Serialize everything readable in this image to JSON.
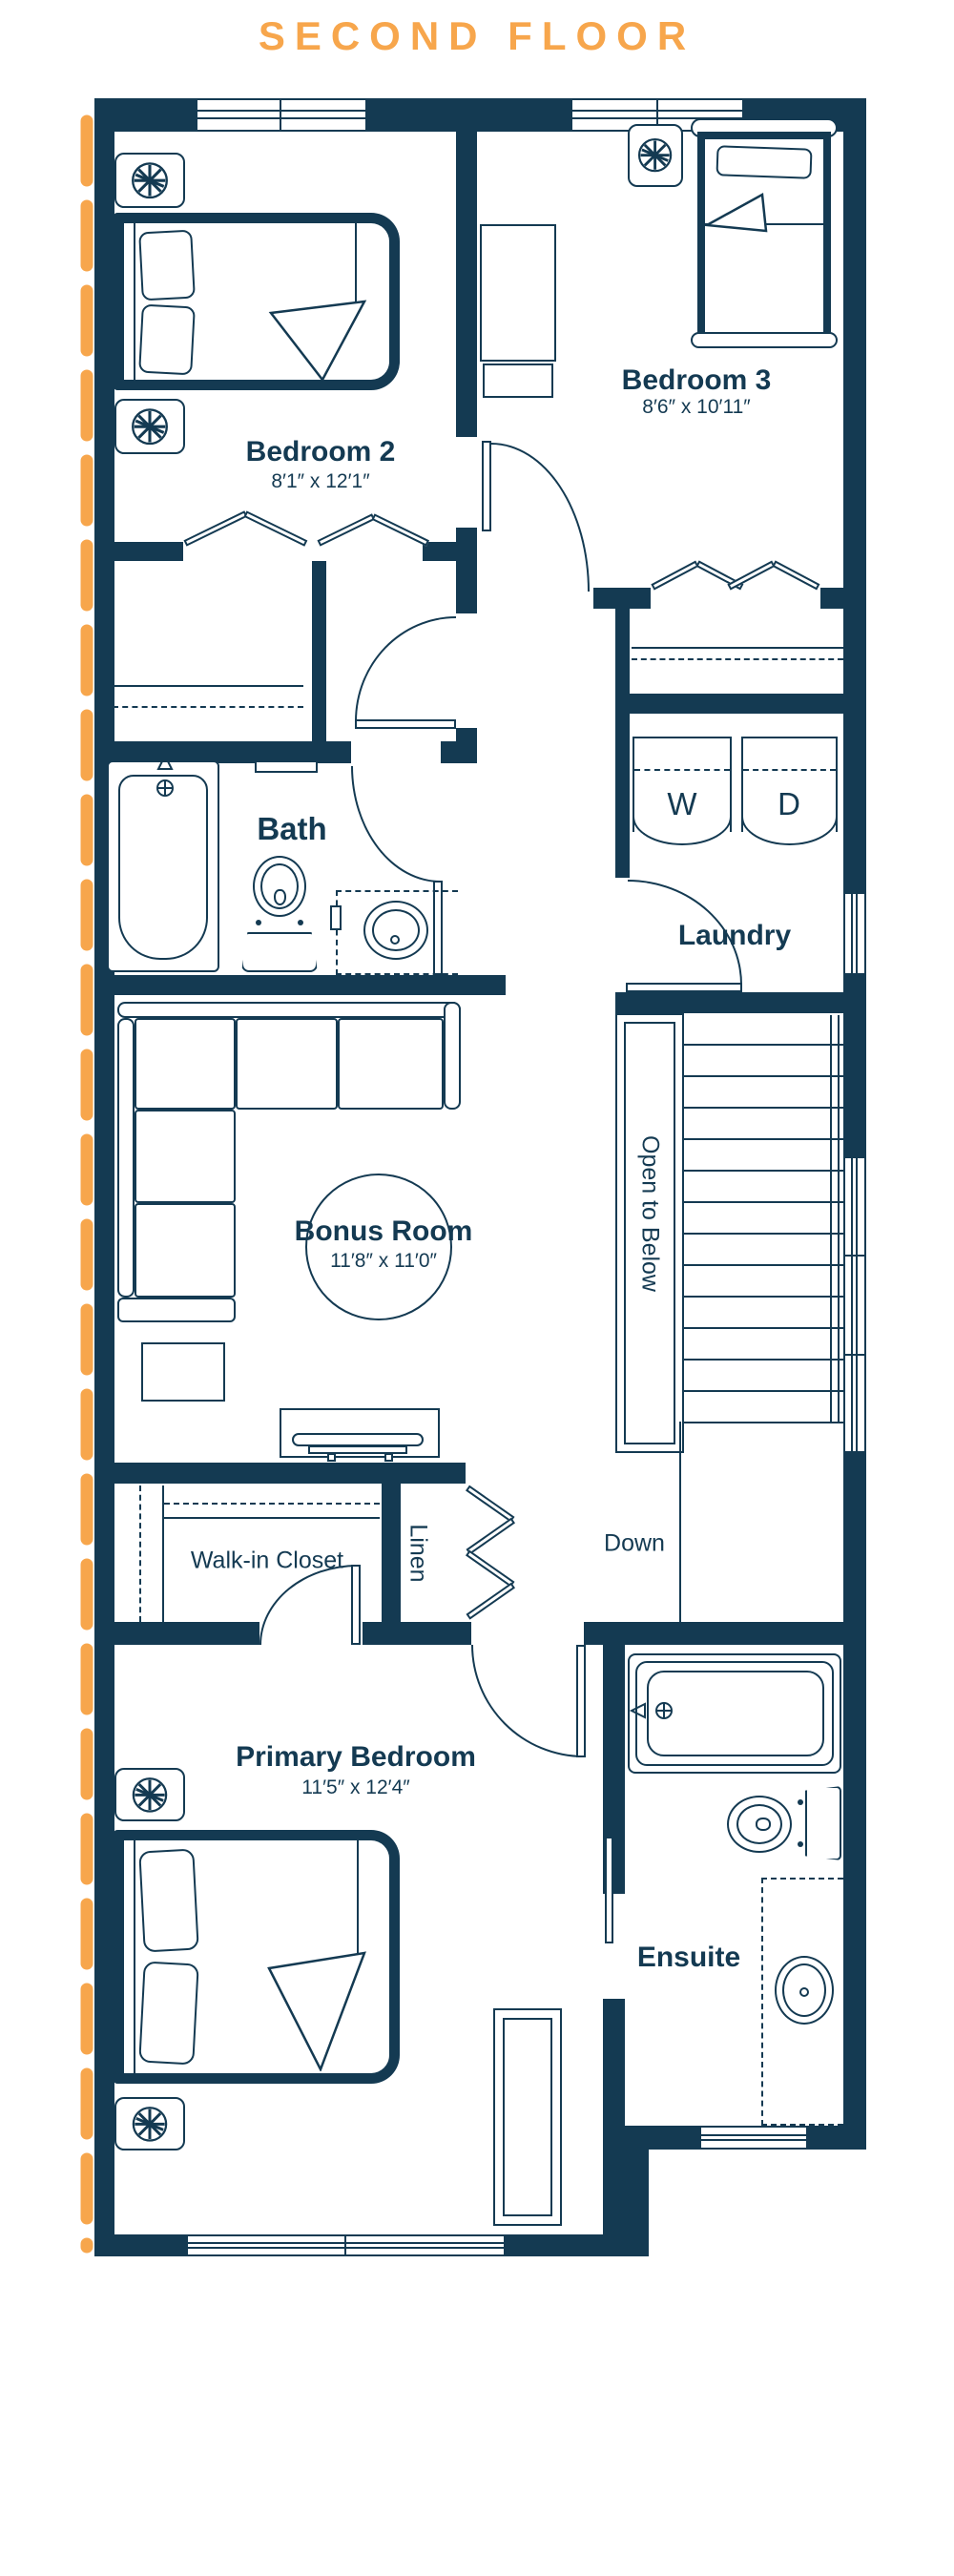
{
  "title": "SECOND FLOOR",
  "colors": {
    "navy": "#143A52",
    "orange": "#F7A64C",
    "background": "#FFFFFF"
  },
  "rooms": {
    "bedroom2": {
      "name": "Bedroom 2",
      "dims": "8′1″ x 12′1″"
    },
    "bedroom3": {
      "name": "Bedroom 3",
      "dims": "8′6″ x 10′11″"
    },
    "bath": {
      "name": "Bath"
    },
    "laundry": {
      "name": "Laundry"
    },
    "bonus": {
      "name": "Bonus Room",
      "dims": "11′8″ x 11′0″"
    },
    "primary": {
      "name": "Primary Bedroom",
      "dims": "11′5″ x 12′4″"
    },
    "ensuite": {
      "name": "Ensuite"
    },
    "walkin": {
      "name": "Walk-in Closet"
    },
    "linen": {
      "name": "Linen"
    }
  },
  "stairs": {
    "open_to_below": "Open to Below",
    "down": "Down"
  },
  "appliances": {
    "washer": "W",
    "dryer": "D"
  }
}
